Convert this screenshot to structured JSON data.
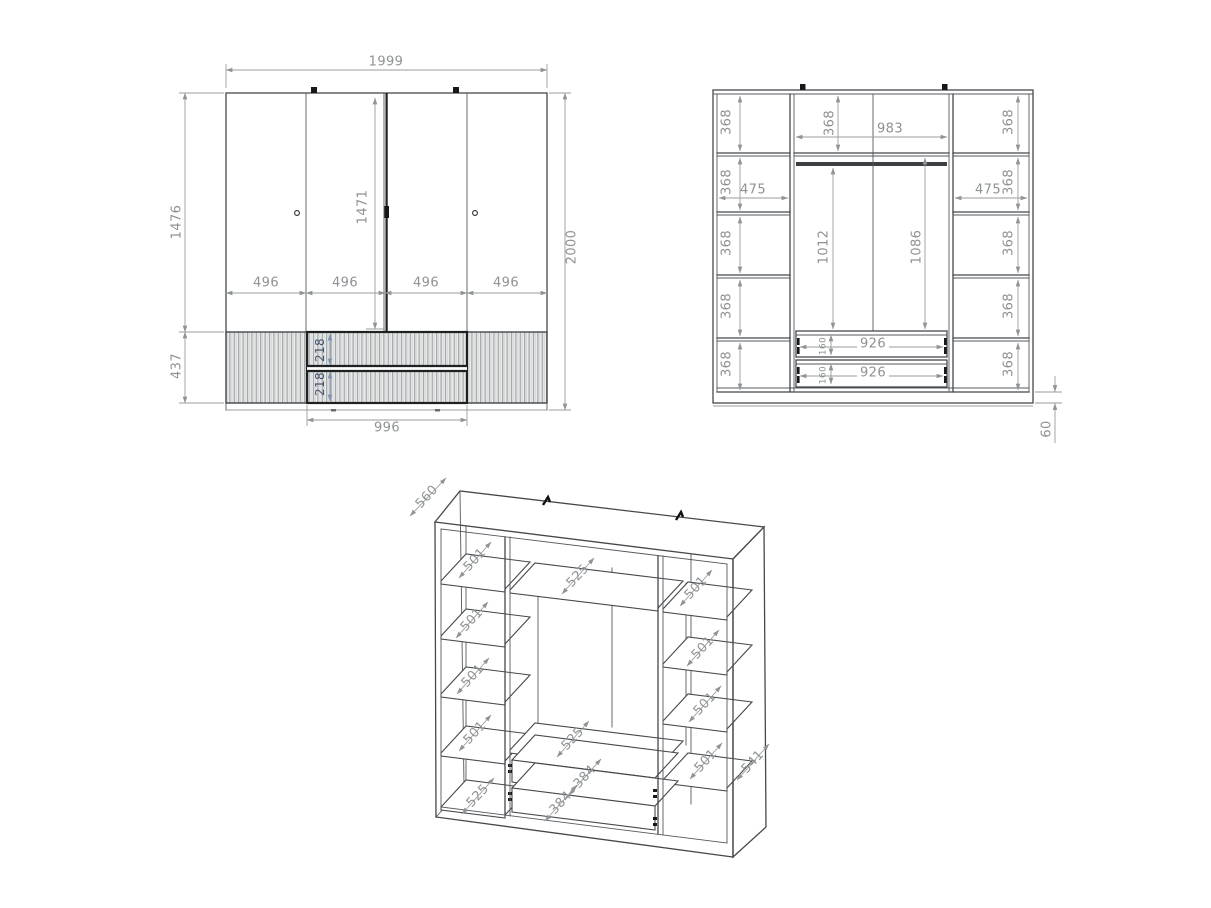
{
  "drawing": {
    "front": {
      "overall_width": "1999",
      "overall_height": "2000",
      "door_height": "1476",
      "base_height": "437",
      "inner_height": "1471",
      "door_widths": [
        "496",
        "496",
        "496",
        "496"
      ],
      "drawer_front_heights": [
        "218",
        "218"
      ],
      "drawer_section_width": "996"
    },
    "interior": {
      "left_cell_heights": [
        "368",
        "368",
        "368",
        "368",
        "368"
      ],
      "right_cell_heights": [
        "368",
        "368",
        "368",
        "368",
        "368"
      ],
      "left_section_width": "475",
      "right_section_width": "475",
      "center_width": "983",
      "center_top_cell_height": "368",
      "hang_height_left": "1012",
      "hang_height_right": "1086",
      "drawer_widths": [
        "926",
        "926"
      ],
      "drawer_box_heights": [
        "160",
        "160"
      ],
      "plinth_height": "60"
    },
    "perspective": {
      "top_depth": "560",
      "side_depth": "541",
      "left_shelf_depths": [
        "501",
        "501",
        "501",
        "501"
      ],
      "left_bottom_depth": "525",
      "center_shelf_depths": [
        "525",
        "525"
      ],
      "drawer_depths": [
        "384",
        "384"
      ],
      "right_shelf_depths": [
        "501",
        "501",
        "501",
        "501"
      ]
    },
    "colors": {
      "line": "#45494d",
      "dim": "#8e9294",
      "accent_dim": "#44546a",
      "hatch_bg": "#eaebeb",
      "background": "#ffffff"
    }
  }
}
